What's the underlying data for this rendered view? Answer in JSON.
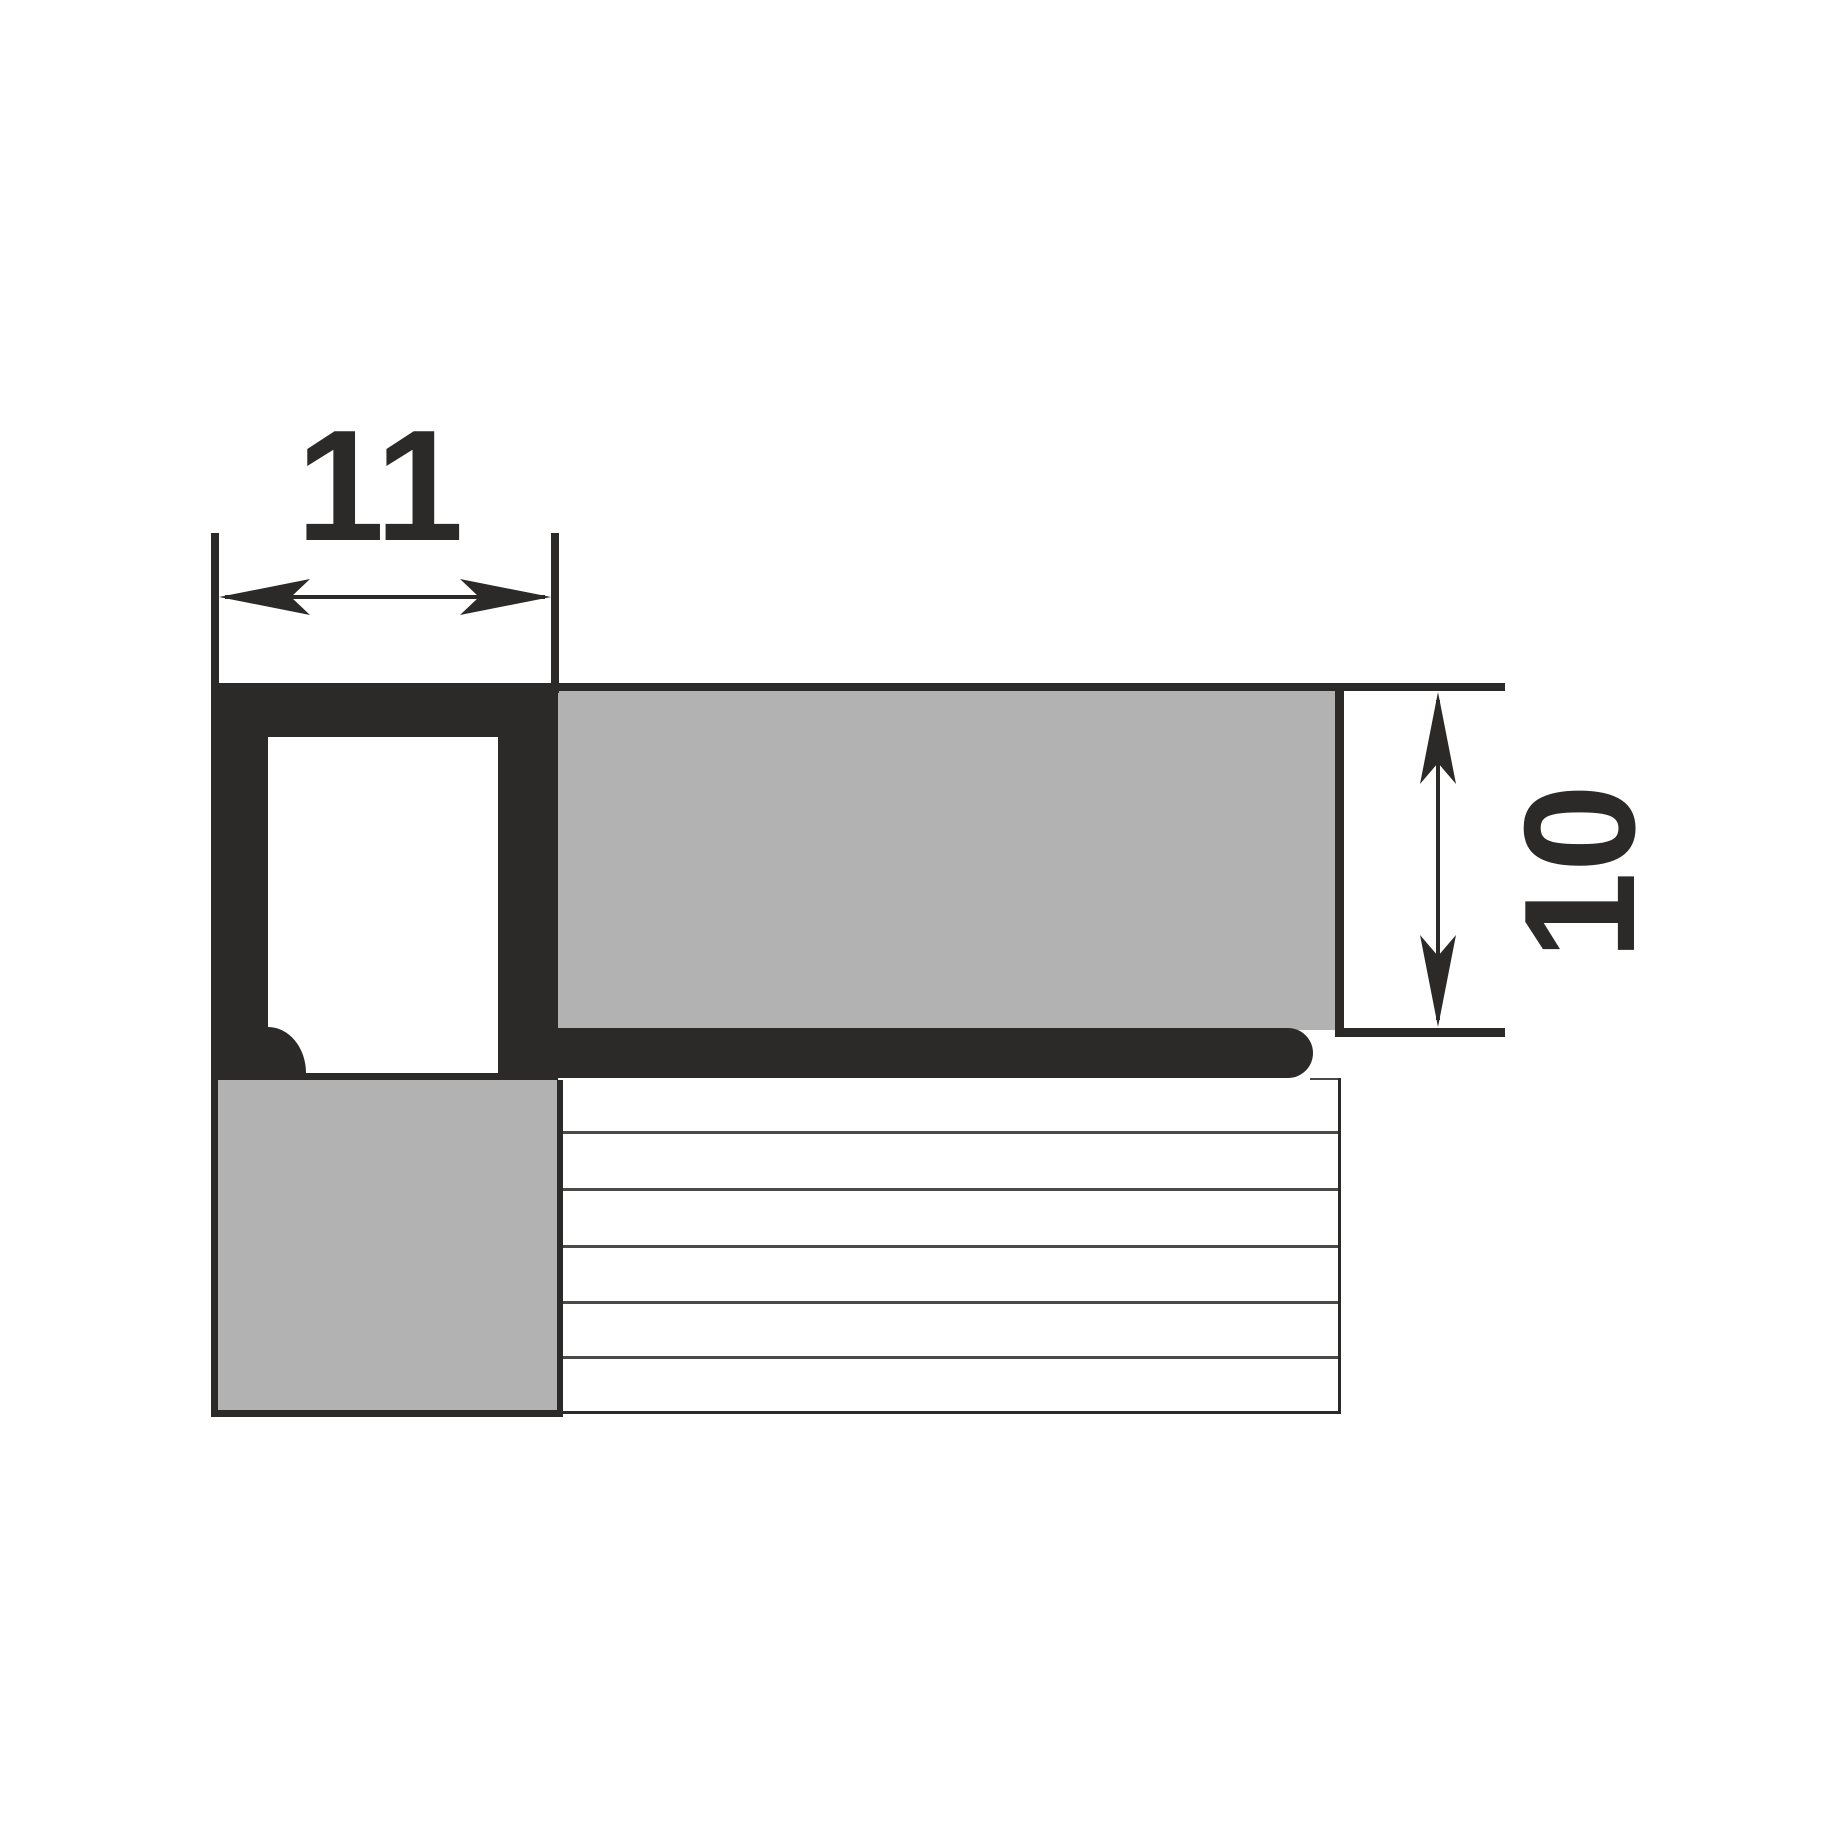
{
  "drawing": {
    "dimensions": {
      "width_label": "11",
      "height_label": "10"
    },
    "colors": {
      "background": "#ffffff",
      "outline": "#2b2a29",
      "tile_fill": "#b2b2b2",
      "grid_line": "#4a4a48"
    }
  }
}
